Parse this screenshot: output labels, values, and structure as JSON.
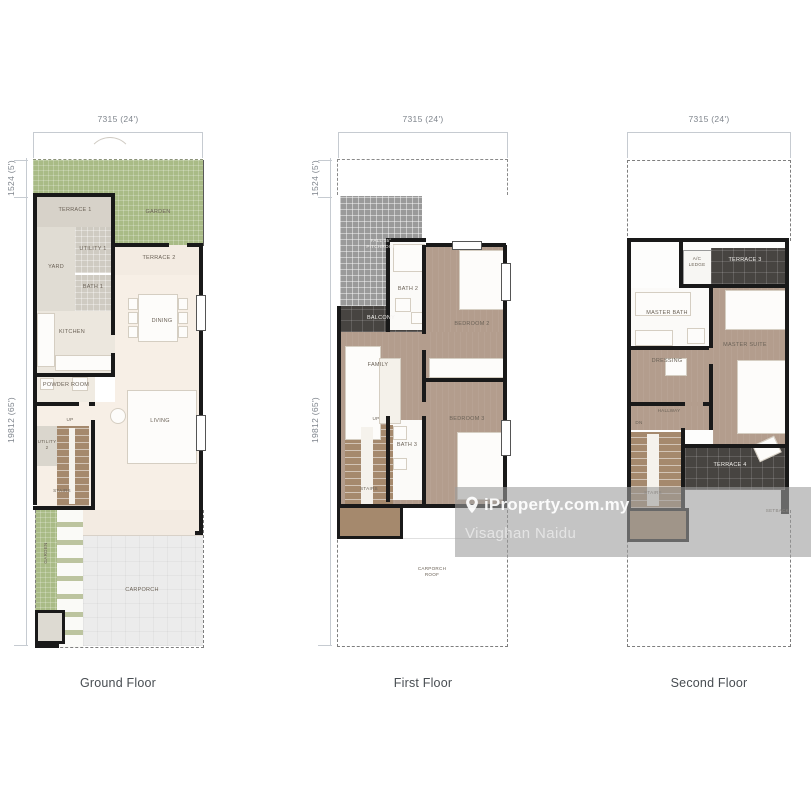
{
  "palette": {
    "garden_green": "#a9bb86",
    "floor_cream": "#f7efe6",
    "bedroom_brown": "#b39d8d",
    "stairs_brown": "#a5896d",
    "terrace_dark": "#474441",
    "pitchroof_gray": "#9a9a9a",
    "carporch_gray": "#ececec",
    "wall_black": "#191919",
    "dimension_text": "#7f858d",
    "watermark_text": "#ffffff"
  },
  "watermark": {
    "brand": "iProperty.com.my",
    "user": "Visaghan Naidu",
    "icon": "location-pin"
  },
  "floors": {
    "ground": {
      "title": "Ground Floor",
      "dims": {
        "top": "7315 (24')",
        "left_upper": "1524 (5')",
        "left_lower": "19812 (65')"
      },
      "rooms": {
        "terrace1": "TERRACE 1",
        "garden": "GARDEN",
        "yard": "YARD",
        "utility1": "UTILITY 1",
        "bath1": "BATH 1",
        "terrace2": "TERRACE 2",
        "kitchen": "KITCHEN",
        "dining": "DINING",
        "powder": "POWDER ROOM",
        "up": "UP",
        "utility2": "UTILITY 2",
        "stairs": "STAIRS",
        "living": "LIVING",
        "side_garden": "GARDEN",
        "carporch": "CARPORCH"
      }
    },
    "first": {
      "title": "First Floor",
      "dims": {
        "top": "7315 (24')",
        "left_upper": "1524 (5')",
        "left_lower": "19812 (65')"
      },
      "rooms": {
        "pitchroof": "FALL 15° PITCHROOF",
        "balcony": "BALCONY",
        "bath2": "BATH 2",
        "bedroom2": "BEDROOM 2",
        "family": "FAMILY",
        "bedroom3": "BEDROOM 3",
        "bath3": "BATH 3",
        "up": "UP",
        "stairs": "STAIRS",
        "carporch_roof": "CARPORCH ROOF"
      }
    },
    "second": {
      "title": "Second Floor",
      "dims": {
        "top": "7315 (24')"
      },
      "rooms": {
        "ac_ledge": "A/C LEDGE",
        "terrace3": "TERRACE 3",
        "master_bath": "MASTER BATH",
        "dressing": "DRESSING",
        "master_suite": "MASTER SUITE",
        "hallway": "HALLWAY",
        "dn": "DN",
        "stairs": "STAIRS",
        "terrace4": "TERRACE 4",
        "setback": "SETBACK"
      }
    }
  }
}
